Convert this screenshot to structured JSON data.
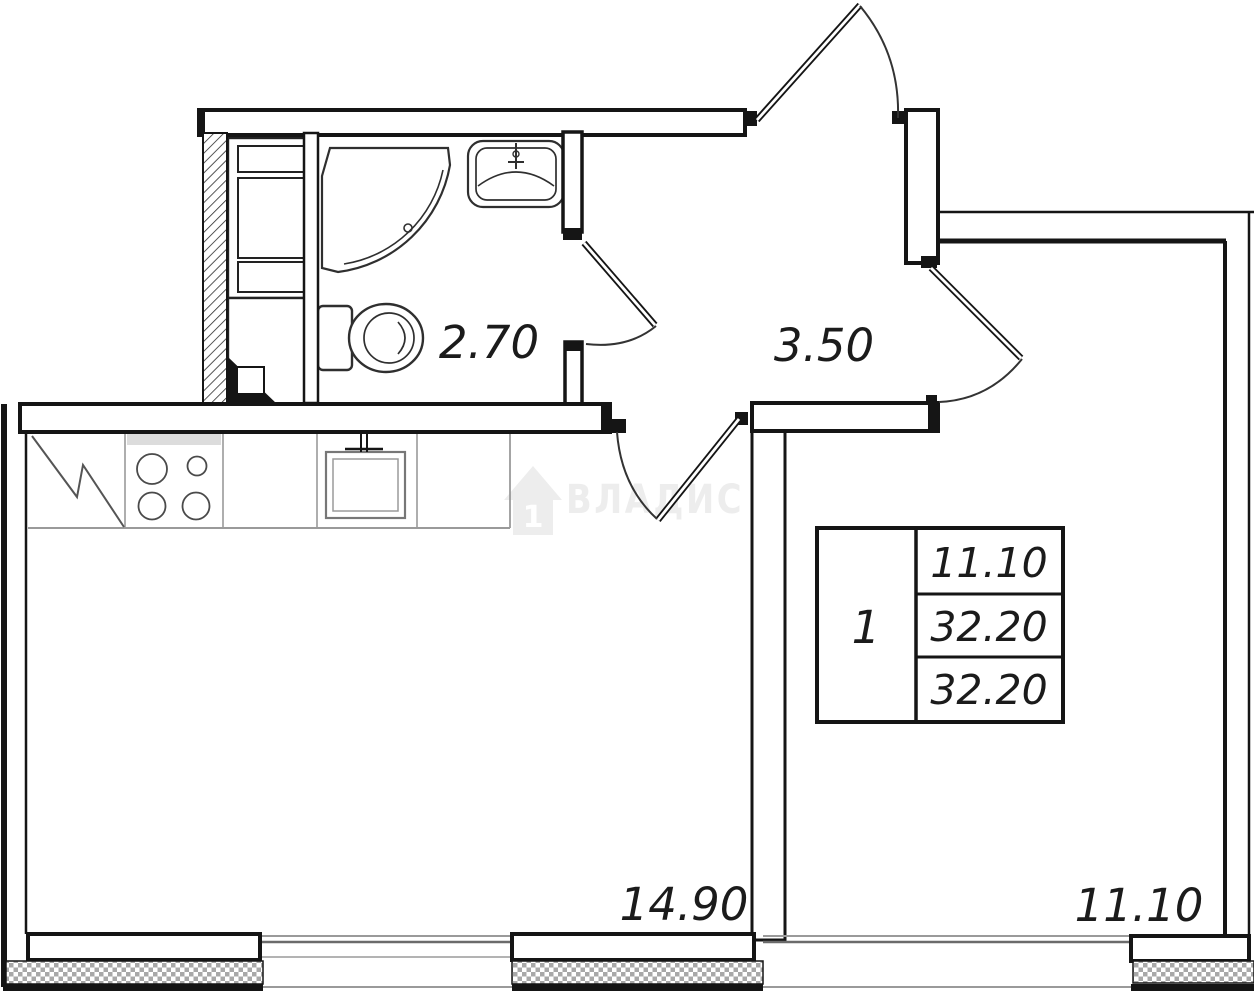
{
  "watermark": {
    "brand": "ВЛАДИС",
    "house_number": "1"
  },
  "rooms": [
    {
      "name": "bathroom",
      "area": "2.70"
    },
    {
      "name": "hallway",
      "area": "3.50"
    },
    {
      "name": "kitchen-living-room",
      "area": "14.90"
    },
    {
      "name": "bedroom",
      "area": "11.10"
    }
  ],
  "stamp": {
    "rooms_count": "1",
    "rows": [
      "11.10",
      "32.20",
      "32.20"
    ]
  },
  "colors": {
    "line": "#151515",
    "thin_gray": "#9a9a9a",
    "fixture": "#3a3a3a",
    "watermark": "#ededed"
  }
}
